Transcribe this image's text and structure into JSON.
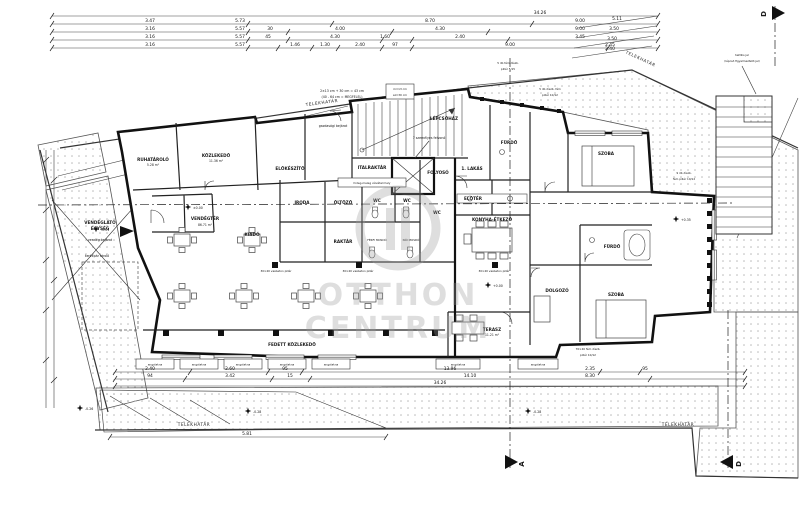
{
  "watermark": {
    "line1": "OTTHON",
    "line2": "CENTRUM"
  },
  "boundary": {
    "label": "TELEKHATÁR"
  },
  "sections": {
    "a": "A",
    "d": "D"
  },
  "rooms": {
    "ruhatarolo": {
      "name": "RUHATÁROLÓ",
      "area": "5.28 m²"
    },
    "kozlekedo": {
      "name": "KÖZLEKEDŐ",
      "area": "11.36 m²"
    },
    "elokeszito": {
      "name": "ELŐKÉSZÍTŐ"
    },
    "iroda": {
      "name": "IRODA"
    },
    "oltozo": {
      "name": "ÖLTÖZŐ"
    },
    "raktar": {
      "name": "RAKTÁR"
    },
    "wc": {
      "name": "WC"
    },
    "ferfi_mosdo": {
      "name": "FÉRFI MOSDÓ"
    },
    "noi_mosdo": {
      "name": "NŐI MOSDÓ"
    },
    "vendegter": {
      "name": "VENDÉGTÉR",
      "area": "86.71 m²"
    },
    "kiado": {
      "name": "KIADÓ"
    },
    "italraktar": {
      "name": "ITALRAKTÁR"
    },
    "lepcsohaz": {
      "name": "LÉPCSŐHÁZ"
    },
    "folyoso": {
      "name": "FOLYOSÓ"
    },
    "lakas1": {
      "name": "1. LAKÁS"
    },
    "eloter": {
      "name": "ELŐTÉR"
    },
    "furdo": {
      "name": "FÜRDŐ"
    },
    "konyha_etkezo": {
      "name": "KONYHA-ÉTKEZŐ"
    },
    "szoba": {
      "name": "SZOBA"
    },
    "dolgozo": {
      "name": "DOLGOZÓ"
    },
    "terasz": {
      "name": "TERASZ",
      "area": "11.21 m²"
    },
    "fedett_kozlekedo": {
      "name": "FEDETT KÖZLEKEDŐ"
    }
  },
  "annotations": {
    "vendeglato_line1": "VENDÉGLÁTÓ",
    "vendeglato_line2": "EGYSÉG",
    "vendeg_bejarat": "vendég bejárat",
    "gazdasagi_bejarat": "gazdasági bejárat",
    "kerekpar_tarolo": "kerékpár tároló",
    "felvono": "7 személyes felvonó",
    "vizvetel": "hideg-meleg vízvételi hely",
    "calc1": "2×13 cm + 30 cm = 43 cm",
    "calc2": "(40 - 64 cm = MEGFELEL)",
    "riser1": "m=13 cm",
    "riser2": "sz=30 cm",
    "taktilis1": "taktilis jel",
    "taktilis2": "(lépcső figyelmeztető jel)",
    "vb_pillar": "30×40 vasbeton pillér",
    "fem9_1": "9 db díszb.",
    "fem9_2": "fém pillér 10/12",
    "fem5a_1": "5 db fém díszb.",
    "fem5a_2": "pillér 5/15",
    "fem5b_1": "5 db díszb. fém",
    "fem5b_2": "pillér 10/12",
    "fem70_1": "70×40 fém díszb.",
    "fem70_2": "pillér 10/12",
    "angolakna": "angolakna"
  },
  "elevations": {
    "zero": "±0.00",
    "plus_zero": "+0.00",
    "minus_001": "-0.01",
    "minus_026": "-0.26",
    "minus_028": "-0.28",
    "plus_035": "+0.35"
  },
  "dims": {
    "total_top": "34.26",
    "rowB": [
      "3.47",
      "5.73",
      "8.70",
      "9.00"
    ],
    "rowC": [
      "3.16",
      "5.57",
      "30",
      "4.00",
      "4.30",
      "9.00"
    ],
    "rowD": [
      "3.16",
      "5.57",
      "45",
      "4.30",
      "1.60",
      "2.40",
      "3.45"
    ],
    "rowE": [
      "3.16",
      "5.57",
      "1.46",
      "1.30",
      "2.40",
      "97",
      "9.00",
      "2.45"
    ],
    "right": [
      "5.11",
      "3.50",
      "3.50",
      "2.40"
    ],
    "bottom1": [
      "2.40",
      "2.60",
      "95",
      "13.96",
      "2.35",
      "95"
    ],
    "bottom2": [
      "94",
      "3.42",
      "15",
      "14.10",
      "8.30"
    ],
    "total_bottom": "34.26",
    "wedge": "5.81"
  }
}
